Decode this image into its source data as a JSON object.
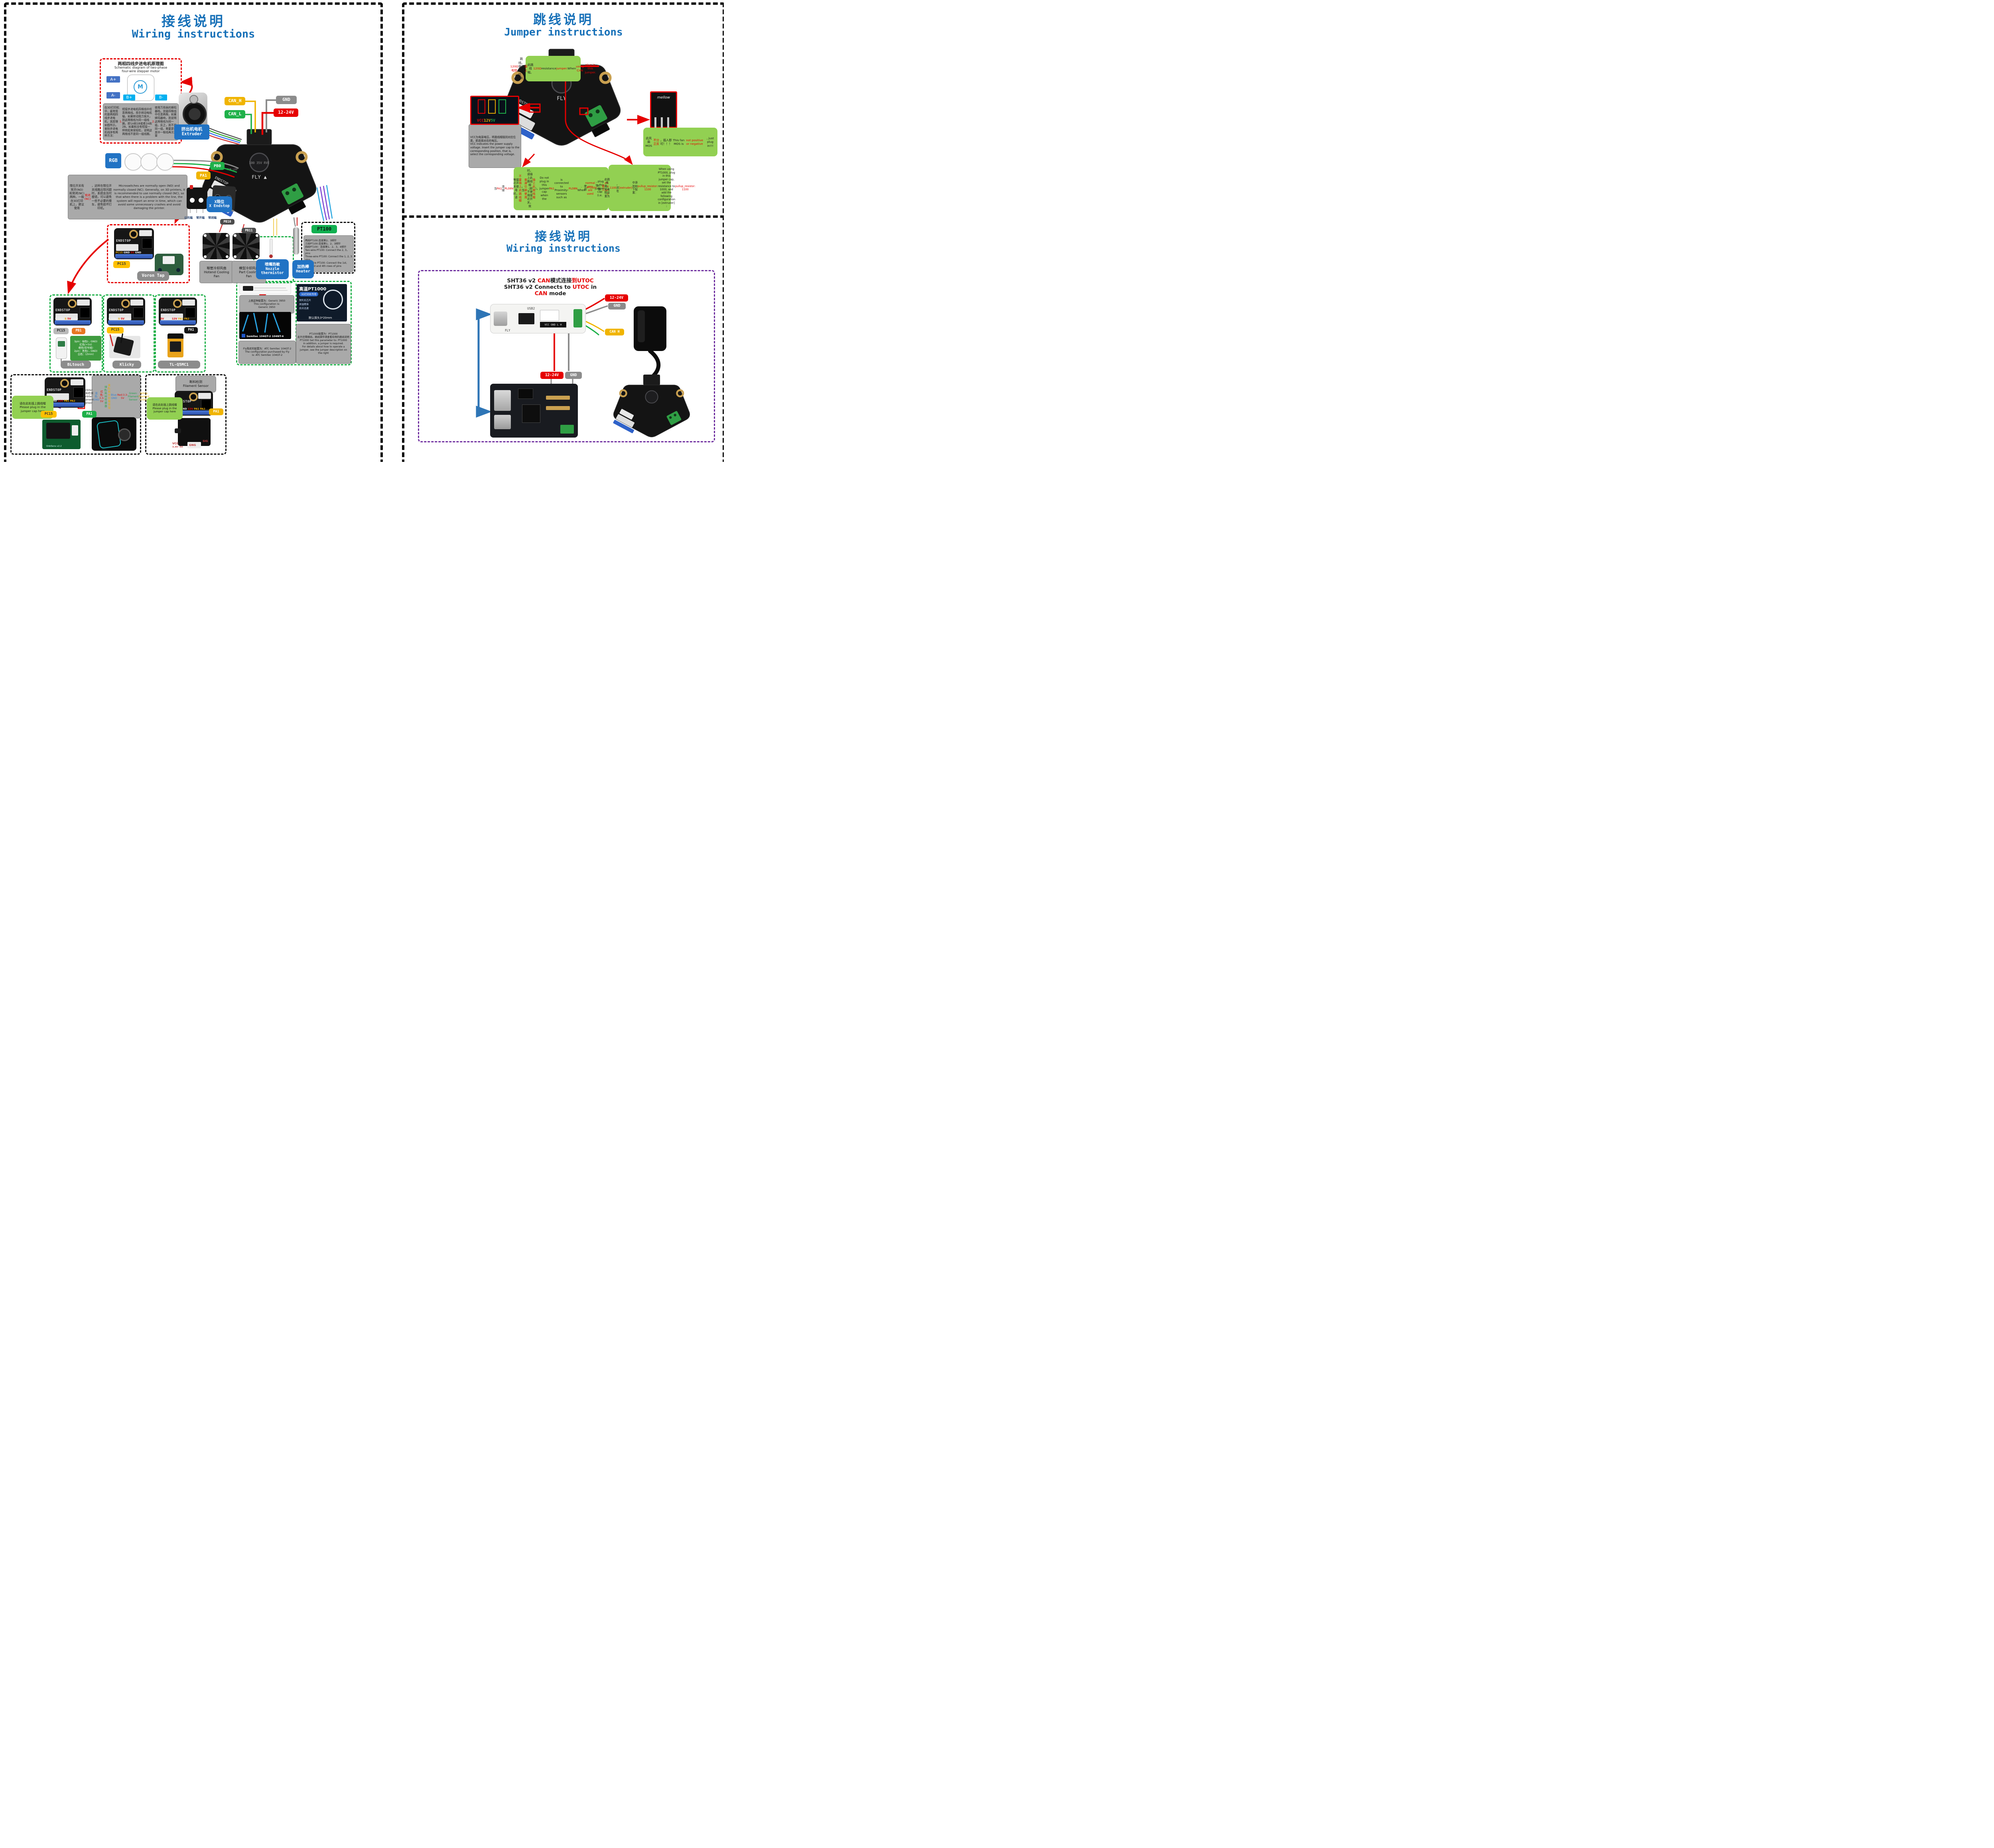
{
  "colors": {
    "title_blue": "#1670b8",
    "label_blue": "#2173c4",
    "yellow": "#f0b400",
    "green": "#1fb14a",
    "red": "#e60000",
    "orange": "#e87722",
    "gray_tag": "#8c8c8c",
    "gray_box": "#a9a9a9",
    "light_green": "#92d052",
    "info_green": "#3f9b3f",
    "pc15_yellow": "#ffc000",
    "black_tag": "#151515"
  },
  "left": {
    "title_zh": "接线说明",
    "title_en": "Wiring instructions",
    "mini_silk": "ENDSTOP",
    "stepper": {
      "title_zh": "两相四线步进电机原理图",
      "title_en": "Schematic diagram of two-phase\nfour-wire stepper motor",
      "a_plus": "A+",
      "a_minus": "A-",
      "b_plus": "B+",
      "b_minus": "B-",
      "motor_m": "M",
      "body": [
        {
          "t": "在3D打印机中，最常用的是两相四线步进电机，其原理如图所示。鉴别步进电机线序有两种方法：",
          "c": "k"
        },
        {
          "t": "1.",
          "c": "r"
        },
        {
          "t": "短接步进电机四根线中任意两根线，用手转动电机轴，如果转动阻力很大，则这两根线为同一组线圈，即1A和1B或者2A和2B。如果和没有短接一样转起来很轻松，说明这两根线不是同一组线圈。",
          "c": "k"
        },
        {
          "t": "2.",
          "c": "r"
        },
        {
          "t": "使用万用表的蜂鸣器档，测量四根线中任意两根，如果蜂鸣器响，则说明这两根线为同一组。反之，则不是同一组，需要更换其中一根线再次测量",
          "c": "k"
        }
      ]
    },
    "tags": {
      "can_h": "CAN_H",
      "can_l": "CAN_L",
      "gnd": "GND",
      "power": "12-24V",
      "extruder": "挤出机电机\nExtruder",
      "rgb": "RGB",
      "pb0": "PB0",
      "pa1": "PA1",
      "fan0": "PB10",
      "fan1": "PB11"
    },
    "board": {
      "silk_fly": "FLY",
      "silk_endstop": "ENDSTOP",
      "silk_rgb": "RGB LED",
      "silk_cap": "100 35V RVE"
    },
    "endstop": {
      "body": [
        {
          "t": "限位开关有常开(NO)和常闭(NC)两种。一般在3D打印机上，建议使用",
          "c": "k"
        },
        {
          "t": "常闭(NC)",
          "c": "r"
        },
        {
          "t": "，这样在限位开关线路出现问题时，系统会及时报错，可以避免一些不必要的撞车，避免损坏打印机。\n",
          "c": "k"
        },
        {
          "t": "Microswitches are normally open (NO) and normally closed (NC). Generally, on 3D printers, it is recommended to use normally closed (NC), so that when there is a problem with the line, the system will report an error in time, which can avoid some unnecessary crashes and avoid damaging the printer.",
          "c": "k"
        }
      ],
      "pin_common": "公共端",
      "pin_no": "常开端",
      "pin_nc": "常闭端",
      "x_label": "X限位\nX Endstop"
    },
    "fans": [
      {
        "label": "喉管冷却风扇\nHotend Cooling\nFan"
      },
      {
        "label": "模型冷却风扇\nPart Cooling\nFan"
      }
    ],
    "thermistor": "喷嘴热敏\nNozzle\nthermistor",
    "heater": "加热棒\nHeater",
    "pt100": {
      "label": "PT100",
      "body": "两线PT100:连接第2、3排针\n三线PT100:连接第1、2、3排针\n四线PT100：连接第1、2、3、4排针\nTwo-wire PT100: Connect the 2, 3，pins\nThree-wire PT100: Connect the 1, 2, 3 pins\nFour-wire PT100: Connect the 1st, 2nd, 3rd and 4th rows of pins"
    },
    "voron": {
      "pins": [
        {
          "t": "PC15 ",
          "c": "y"
        },
        {
          "t": "GND ",
          "c": "w"
        },
        {
          "t": "5V ",
          "c": "r"
        },
        {
          "t": "GND",
          "c": "w"
        }
      ],
      "pc15": "PC15",
      "label": "Voron Tap"
    },
    "bltouch": {
      "pins": [
        {
          "t": "S ",
          "c": "w"
        },
        {
          "t": "GND ",
          "c": "w"
        },
        {
          "t": "S ",
          "c": "y"
        },
        {
          "t": "5V ",
          "c": "r"
        },
        {
          "t": "GND",
          "c": "w"
        }
      ],
      "pc15": "PC15",
      "pb1": "PB1",
      "info": "3pin：绿色(-, GND)\n红色(+5V)\n橙色(信号线)\n2pin：黑色(-, GND)\n白色：(Zmin)",
      "label": "BLtouch"
    },
    "klicky": {
      "pins": [
        {
          "t": "S ",
          "c": "w"
        },
        {
          "t": "GND ",
          "c": "w"
        },
        {
          "t": "S ",
          "c": "y"
        },
        {
          "t": "5V ",
          "c": "r"
        },
        {
          "t": "GND",
          "c": "w"
        }
      ],
      "pc15": "PC15",
      "label": "Klicky"
    },
    "tl": {
      "pins": [
        {
          "t": "5V ",
          "c": "r"
        },
        {
          "t": "GND ",
          "c": "w"
        },
        {
          "t": "12V ",
          "c": "r"
        },
        {
          "t": "PA1 ",
          "c": "y"
        },
        {
          "t": "PA2",
          "c": "y"
        }
      ],
      "pa1": "PA1",
      "label": "TL-Q5MC1",
      "sensor_brand": "omron"
    },
    "config": {
      "g3950": "上图这种配置为：Generic 3950\nThis configuration is:\nGeneric 3950",
      "semitec_caption": "Semitec 104GT-2 104NT-4",
      "fly": "Fly购买的配置为：ATC Semitec 104GT-2\nThe configuration purchased by Fly\nis: ATC Semitec 104GT-2",
      "pt1000_product": {
        "l1": "高温PT1000",
        "l2": "3D打印机专用",
        "l3": "贺利氏芯片",
        "l4": "测温精准",
        "l5": "反应迅速",
        "l6": "默认探头3*20mm"
      },
      "pt1000_note": "PT1000配置为：PT1000\n此外还需跳线，跳线操作请查看右侧的跳线说明\nPT1000 Set this parameter to: PT1000\nIn addition, a jumper is required.\nFor details about how to operate a jumper, see the jumper description on the right"
    },
    "orbiter": {
      "plug": "请在此处插上跳线帽\nPlease plug in the\njumper cap here",
      "pc15": "PC15",
      "pa1": "PA1",
      "pins": [
        {
          "t": "5V ",
          "c": "r"
        },
        {
          "t": "GND ",
          "c": "w"
        },
        {
          "t": "12V ",
          "c": "r"
        },
        {
          "t": "PA1 ",
          "c": "y"
        },
        {
          "t": "PA2",
          "c": "y"
        }
      ],
      "pcb_silk": "OrbiSens v2.2",
      "info": [
        {
          "t": "Orbiter断料检测\nOrbiter Filament Sensor\n",
          "c": "k"
        },
        {
          "t": "蓝色: GND\n",
          "c": "b"
        },
        {
          "t": "红色: 3.3-5V\n",
          "c": "r"
        },
        {
          "t": "绿色: 耗材传感器\n",
          "c": "g"
        },
        {
          "t": "黄色: 耗材卸载按钮\n",
          "c": "y"
        },
        {
          "t": "Blue: GND\n",
          "c": "b"
        },
        {
          "t": "Red:3.3-5V\n",
          "c": "r"
        },
        {
          "t": "Green: Filament Sensor\n",
          "c": "g"
        },
        {
          "t": "Yellow: Filament Unload",
          "c": "y"
        }
      ]
    },
    "filament": {
      "title": "断料检测\nFilament Sensor",
      "plug": "请在此处插上跳线帽\nPlease plug in the\njumper cap here",
      "pa1": "PA1",
      "pins": [
        {
          "t": "5V ",
          "c": "r"
        },
        {
          "t": "GND ",
          "c": "w"
        },
        {
          "t": "12V ",
          "c": "r"
        },
        {
          "t": "PA1 ",
          "c": "y"
        },
        {
          "t": "PA2",
          "c": "y"
        }
      ],
      "vcc": "VCC",
      "vcc_sub": "3.3V~5V",
      "gng": "GNG",
      "sig": "SIG"
    }
  },
  "jumper": {
    "title_zh": "跳线说明",
    "title_en": "Jumper instructions",
    "r120": [
      {
        "t": "120Ω电阻",
        "c": "r"
      },
      {
        "t": "跳线。使用CAN时，请",
        "c": "k"
      },
      {
        "t": "插上",
        "c": "r"
      },
      {
        "t": "此跳线帽。\n",
        "c": "k"
      },
      {
        "t": "120Ω",
        "c": "r"
      },
      {
        "t": " resistance ",
        "c": "k"
      },
      {
        "t": "jumper.",
        "c": "r"
      },
      {
        "t": " When ",
        "c": "k"
      },
      {
        "t": "using CAN",
        "c": "r"
      },
      {
        "t": ", ",
        "c": "k"
      },
      {
        "t": "plug in this jumper.",
        "c": "r"
      }
    ],
    "vcc_pins": [
      {
        "t": "VCC",
        "c": "r"
      },
      {
        "t": "12V",
        "c": "y"
      },
      {
        "t": "5V",
        "c": "g"
      }
    ],
    "vcc_note": "VCC为电源电压，将跳线帽插到对应位置，即选择对应的电压。\nVCC indicates the power supply voltage. Insert the jumper cap to the corresponding position, that is, select the corresponding voltage.",
    "mos": [
      {
        "t": "此风扇MOS",
        "c": "k"
      },
      {
        "t": "不分正反",
        "c": "r"
      },
      {
        "t": "，插入即可！！！\n",
        "c": "k"
      },
      {
        "t": "This fan MOS is ",
        "c": "k"
      },
      {
        "t": "not positive or negative",
        "c": "r"
      },
      {
        "t": ", just plug in!!!",
        "c": "k"
      }
    ],
    "mos_logo": "mellow",
    "pa1": [
      {
        "t": "当",
        "c": "k"
      },
      {
        "t": "PA1",
        "c": "r"
      },
      {
        "t": "连接",
        "c": "k"
      },
      {
        "t": "PL08N",
        "c": "r"
      },
      {
        "t": "等接近开关使用时，请",
        "c": "k"
      },
      {
        "t": "不要插上此跳线帽",
        "c": "r"
      },
      {
        "t": "。当",
        "c": "k"
      },
      {
        "t": "普通引脚使用",
        "c": "r"
      },
      {
        "t": "时，请插上此跳线帽（即不使用接近开关，就",
        "c": "k"
      },
      {
        "t": "插上此跳线帽",
        "c": "r"
      },
      {
        "t": "）。\n",
        "c": "k"
      },
      {
        "t": "Do not plug in this jumper cap when the ",
        "c": "k"
      },
      {
        "t": "PA1",
        "c": "r"
      },
      {
        "t": " is connected to Proximity-sensors such as ",
        "c": "k"
      },
      {
        "t": "PL08N",
        "c": "r"
      },
      {
        "t": ". When ",
        "c": "k"
      },
      {
        "t": "normal pins are used",
        "c": "r"
      },
      {
        "t": ", plug in this jumper cap (i.e. ",
        "c": "k"
      },
      {
        "t": "plug in this jumper cap",
        "c": "r"
      },
      {
        "t": " without using the Proximity-sensors).",
        "c": "k"
      }
    ],
    "pt1000": [
      {
        "t": "使用",
        "c": "k"
      },
      {
        "t": "PT1000",
        "c": "r"
      },
      {
        "t": "时，需",
        "c": "k"
      },
      {
        "t": "插上",
        "c": "r"
      },
      {
        "t": "此跳线帽，将电阻设置为",
        "c": "k"
      },
      {
        "t": "1100",
        "c": "r"
      },
      {
        "t": "，并在",
        "c": "k"
      },
      {
        "t": "[extruder]",
        "c": "r"
      },
      {
        "t": "中添加如下配置：\n",
        "c": "k"
      },
      {
        "t": "pullup_resistor: 1100\n",
        "c": "r"
      },
      {
        "t": "When using PT1000, plug in this jumper cap, set the resistance to 1000, and add the following configuration in [extruder] :\n",
        "c": "k"
      },
      {
        "t": "pullup_resistor: 1100",
        "c": "r"
      }
    ],
    "board": {
      "silk_endstop": "ENDSTOP",
      "silk_fly": "FLY"
    }
  },
  "can": {
    "title_zh": "接线说明",
    "title_en": "Wiring instructions",
    "header": [
      {
        "t": "SHT36 v2 ",
        "c": "k"
      },
      {
        "t": "CAN",
        "c": "r"
      },
      {
        "t": "模式连接",
        "c": "k"
      },
      {
        "t": "到",
        "c": "r"
      },
      {
        "t": "UTOC",
        "c": "r"
      },
      {
        "t": "\nSHT36 v2 Connects to ",
        "c": "k"
      },
      {
        "t": "UTOC",
        "c": "r"
      },
      {
        "t": " in\n",
        "c": "k"
      },
      {
        "t": "CAN",
        "c": "r"
      },
      {
        "t": " mode",
        "c": "k"
      }
    ],
    "tags": {
      "power_top": "12-24V",
      "gnd_top": "GND",
      "can_h": "CAN H",
      "power_bottom": "12-24V",
      "gnd_bottom": "GND"
    },
    "stick": {
      "usb2": "USB2",
      "pins": "VCC GND L H",
      "fly": "FLY"
    }
  }
}
